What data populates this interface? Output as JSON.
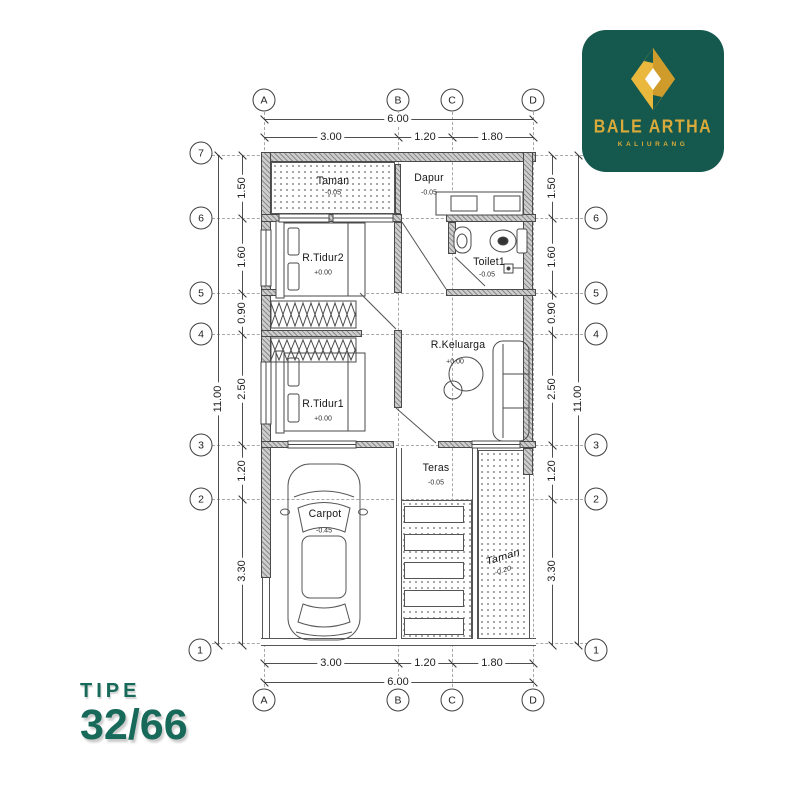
{
  "logo": {
    "title": "BALE ARTHA",
    "subtitle": "KALIURANG",
    "bg_color": "#15594e",
    "gold": "#d9aa3a",
    "gold_fill": "#e9b83d",
    "gold_dark": "#cf9b2b"
  },
  "type_label": {
    "prefix": "TIPE",
    "value": "32/66",
    "color": "#17695a"
  },
  "grid": {
    "columns": [
      "A",
      "B",
      "C",
      "D"
    ],
    "rows": [
      "7",
      "6",
      "5",
      "4",
      "3",
      "2",
      "1"
    ]
  },
  "dims": {
    "top_total": "6.00",
    "top_segments": [
      "3.00",
      "1.20",
      "1.80"
    ],
    "bottom_total": "6.00",
    "bottom_segments": [
      "3.00",
      "1.20",
      "1.80"
    ],
    "side_total": "11.00",
    "side_segments": [
      "1.50",
      "1.60",
      "0.90",
      "2.50",
      "1.20",
      "3.30"
    ]
  },
  "rooms": [
    {
      "name": "Taman",
      "elevation": "-0.05"
    },
    {
      "name": "Dapur",
      "elevation": "-0.05"
    },
    {
      "name": "R.Tidur2",
      "elevation": "+0.00"
    },
    {
      "name": "Toilet1",
      "elevation": "-0.05"
    },
    {
      "name": "R.Keluarga",
      "elevation": "+0.00"
    },
    {
      "name": "R.Tidur1",
      "elevation": "+0.00"
    },
    {
      "name": "Teras",
      "elevation": "-0.05"
    },
    {
      "name": "Carpot",
      "elevation": "-0.45"
    },
    {
      "name": "Taman",
      "elevation": "-0.20"
    }
  ]
}
